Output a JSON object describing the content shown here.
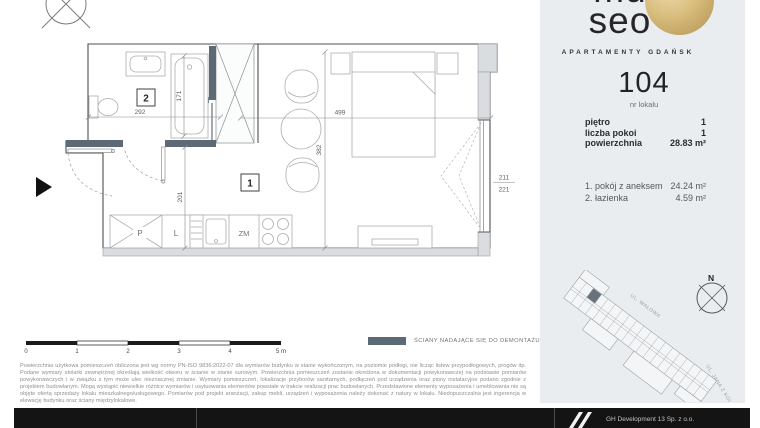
{
  "colors": {
    "gold_accent": "#c9ab6b",
    "demountable_wall": "#5d6a76",
    "panel_bg": "#e9edf0",
    "footer_bg": "#141414"
  },
  "plan": {
    "bath_room_number": "2",
    "main_room_number": "1",
    "dims": {
      "bath_width": "292",
      "tub_length": "171",
      "kitchen_depth": "201",
      "room_width": "499",
      "room_depth": "382",
      "window_upper": "211",
      "window_lower": "221"
    },
    "kitchen": {
      "washer": "P",
      "fridge": "L",
      "dishwasher": "ZM"
    }
  },
  "scalebar": {
    "ticks": [
      "0",
      "1",
      "2",
      "3",
      "4",
      "5 m"
    ]
  },
  "legend": {
    "wall_label": "ŚCIANY NADAJĄCE SIĘ DO DEMONTAŻU"
  },
  "disclaimer": {
    "text": "Powierzchnia użytkowa pomieszczeń obliczona jest wg normy PN-ISO 9836:2022-07 dla wymiarów budynku w stanie wykończonym, na poziomie podłogi, nie licząc listew przypodłogowych, progów itp. Podane wymiary stolarki zewnętrznej określają wielkość otworu w ścianie w stanie surowym. Powierzchnia pomieszczeń zostanie określona w dokumentacji powykonawczej na podstawie pomiarów powykonawczych i w związku z tym może ulec nieznacznej zmianie. Wymiary pomieszczeń, lokalizacje przyborów sanitarnych, podłączeń pod urządzenia oraz piony instalacyjne podano zgodnie z projektem budowlanym. Mogą wystąpić niewielkie różnice wymiarów i usytuowania elementów powstałe w trakcie realizacji prac budowlanych. Przedstawione elementy wyposażenia i umeblowania nie są objęte ofertą sprzedaży lokalu mieszkalnego/usługowego. Pomiarów pod projekt aranżacji, zakup mebli, urządzeń i wyposażenia należy dokonać z natury w lokalu. Niedopuszczalna jest ingerencja w elewację budynku oraz ściany międzylokalowe."
  },
  "sidebar": {
    "logo_top": "mu",
    "logo_bottom": "seo",
    "tagline": "APARTAMENTY GDAŃSK",
    "unit_number": "104",
    "unit_caption": "nr lokalu",
    "specs": [
      {
        "label": "piętro",
        "value": "1"
      },
      {
        "label": "liczba pokoi",
        "value": "1"
      },
      {
        "label": "powierzchnia",
        "value": "28.83 m²"
      }
    ],
    "rooms": [
      {
        "name": "1. pokój z aneksem",
        "area": "24.24 m²"
      },
      {
        "name": "2. łazienka",
        "area": "4.59 m²"
      }
    ],
    "compass_n": "N",
    "street_top": "UL. WAŁOWA",
    "street_side": "UL. JANA Z KOLNA"
  },
  "footer": {
    "company": "GH Development 13 Sp. z o.o."
  }
}
